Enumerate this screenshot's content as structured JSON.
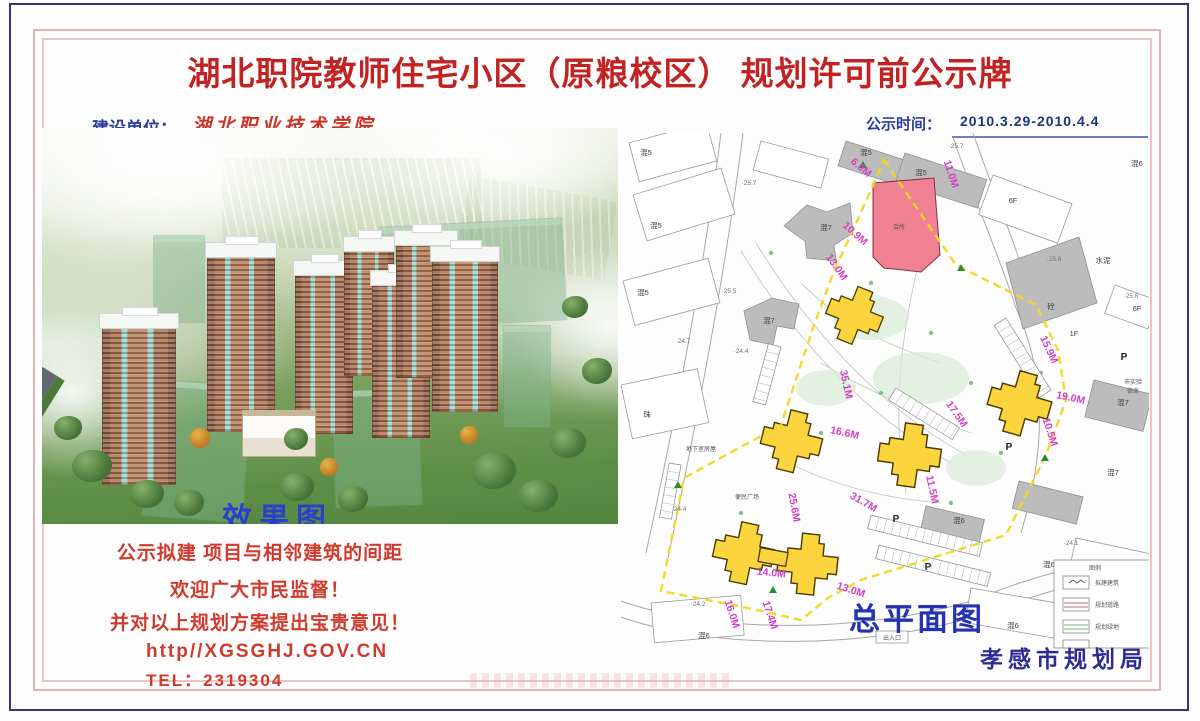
{
  "title": "湖北职院教师住宅小区（原粮校区） 规划许可前公示牌",
  "header": {
    "builder_label": "建设单位：",
    "builder_value": "湖北职业技术学院",
    "time_label": "公示时间：",
    "time_value": "2010.3.29-2010.4.4"
  },
  "left_panel": {
    "caption": "效果图",
    "line1": "公示拟建 项目与相邻建筑的间距",
    "line2": "欢迎广大市民监督！",
    "line3": "并对以上规划方案提出宝贵意见！",
    "line4": "http//XGSGHJ.GOV.CN",
    "line5": "TEL：2319304"
  },
  "map": {
    "caption": "总平面图",
    "agency": "孝感市规划局",
    "dims": [
      "6.0M",
      "10.9M",
      "11.0M",
      "13.0M",
      "35.1M",
      "16.6M",
      "17.5M",
      "15.9M",
      "19.0M",
      "10.5M",
      "25.6M",
      "31.7M",
      "11.5M",
      "14.0M",
      "13.0M",
      "16.0M",
      "17.4M"
    ],
    "texts": [
      "混5",
      "混5",
      "混5",
      "混5",
      "混5",
      "混7",
      "混7",
      "混7",
      "混7",
      "混6",
      "混6",
      "混6",
      "混6",
      "混6",
      "6F",
      "6F",
      "1F",
      "水泥",
      "砼",
      "会所",
      "珠",
      "便民广场",
      "地下室房屋",
      "出入口",
      "市实验",
      "宿舍",
      "P",
      "P",
      "P",
      "P"
    ],
    "elevations": [
      "·25.7",
      "·25.7",
      "·25.5",
      "·24.7",
      "·24.4",
      "·24.4",
      "·24.2",
      "·24.1",
      "·25.6",
      "·25.6"
    ],
    "legend": {
      "title": "图例",
      "items": [
        "拟建建筑",
        "规划道路",
        "规划绿地"
      ]
    }
  }
}
